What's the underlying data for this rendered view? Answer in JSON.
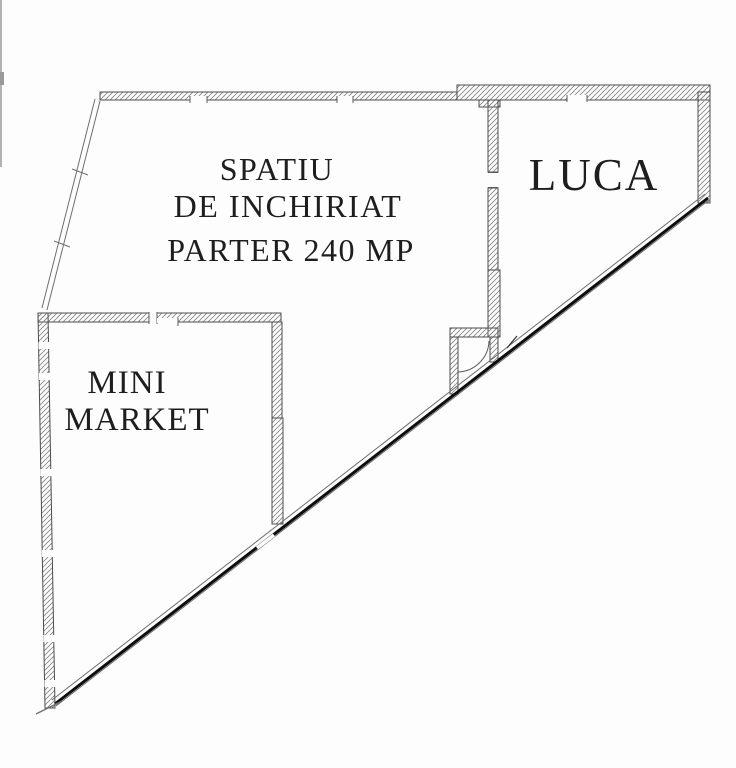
{
  "document_type": "floor-plan",
  "rooms": [
    {
      "id": "spatiu-de-inchiriat",
      "lines": [
        "SPATIU",
        "DE INCHIRIAT",
        "PARTER 240 MP"
      ]
    },
    {
      "id": "luca",
      "lines": [
        "LUCA"
      ]
    },
    {
      "id": "mini-market",
      "lines": [
        "MINI",
        "MARKET"
      ]
    }
  ],
  "colors": {
    "background": "#fdfdfd",
    "wall_outline": "#4d4d4d",
    "hatch": "#8a8a8a",
    "storefront": "#0d0d0d",
    "thin_line": "#6e6e6e",
    "text": "#1e1e1e"
  }
}
